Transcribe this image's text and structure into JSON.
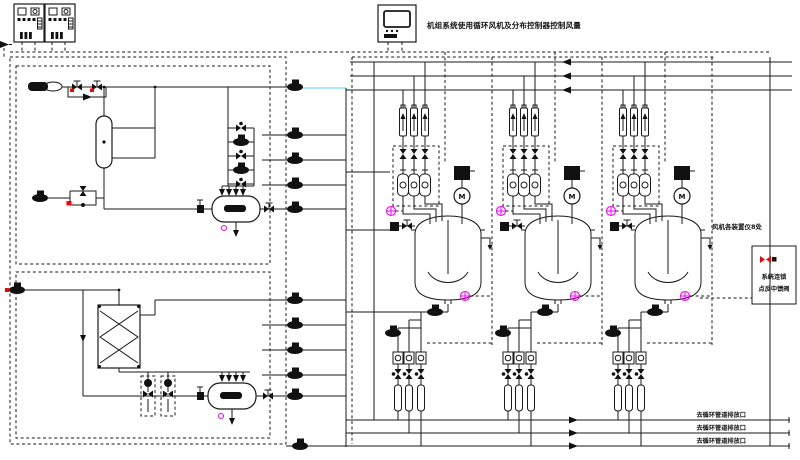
{
  "diagram": {
    "top_caption": "机组系统使用循环风机及分布控制器控制风量",
    "right_note": "风机各装置仪8处",
    "interlock": {
      "line1": "系统连锁",
      "line2": "点反中馈阀"
    },
    "outlets": [
      {
        "label": "去循环管道排放口"
      },
      {
        "label": "去循环管道排放口"
      },
      {
        "label": "去循环管道排放口"
      }
    ],
    "motor_label": "M",
    "colors": {
      "line": "#1a1a1a",
      "red": "#ff0000",
      "magenta": "#ff00ff",
      "cyan": "#8adfff"
    }
  }
}
